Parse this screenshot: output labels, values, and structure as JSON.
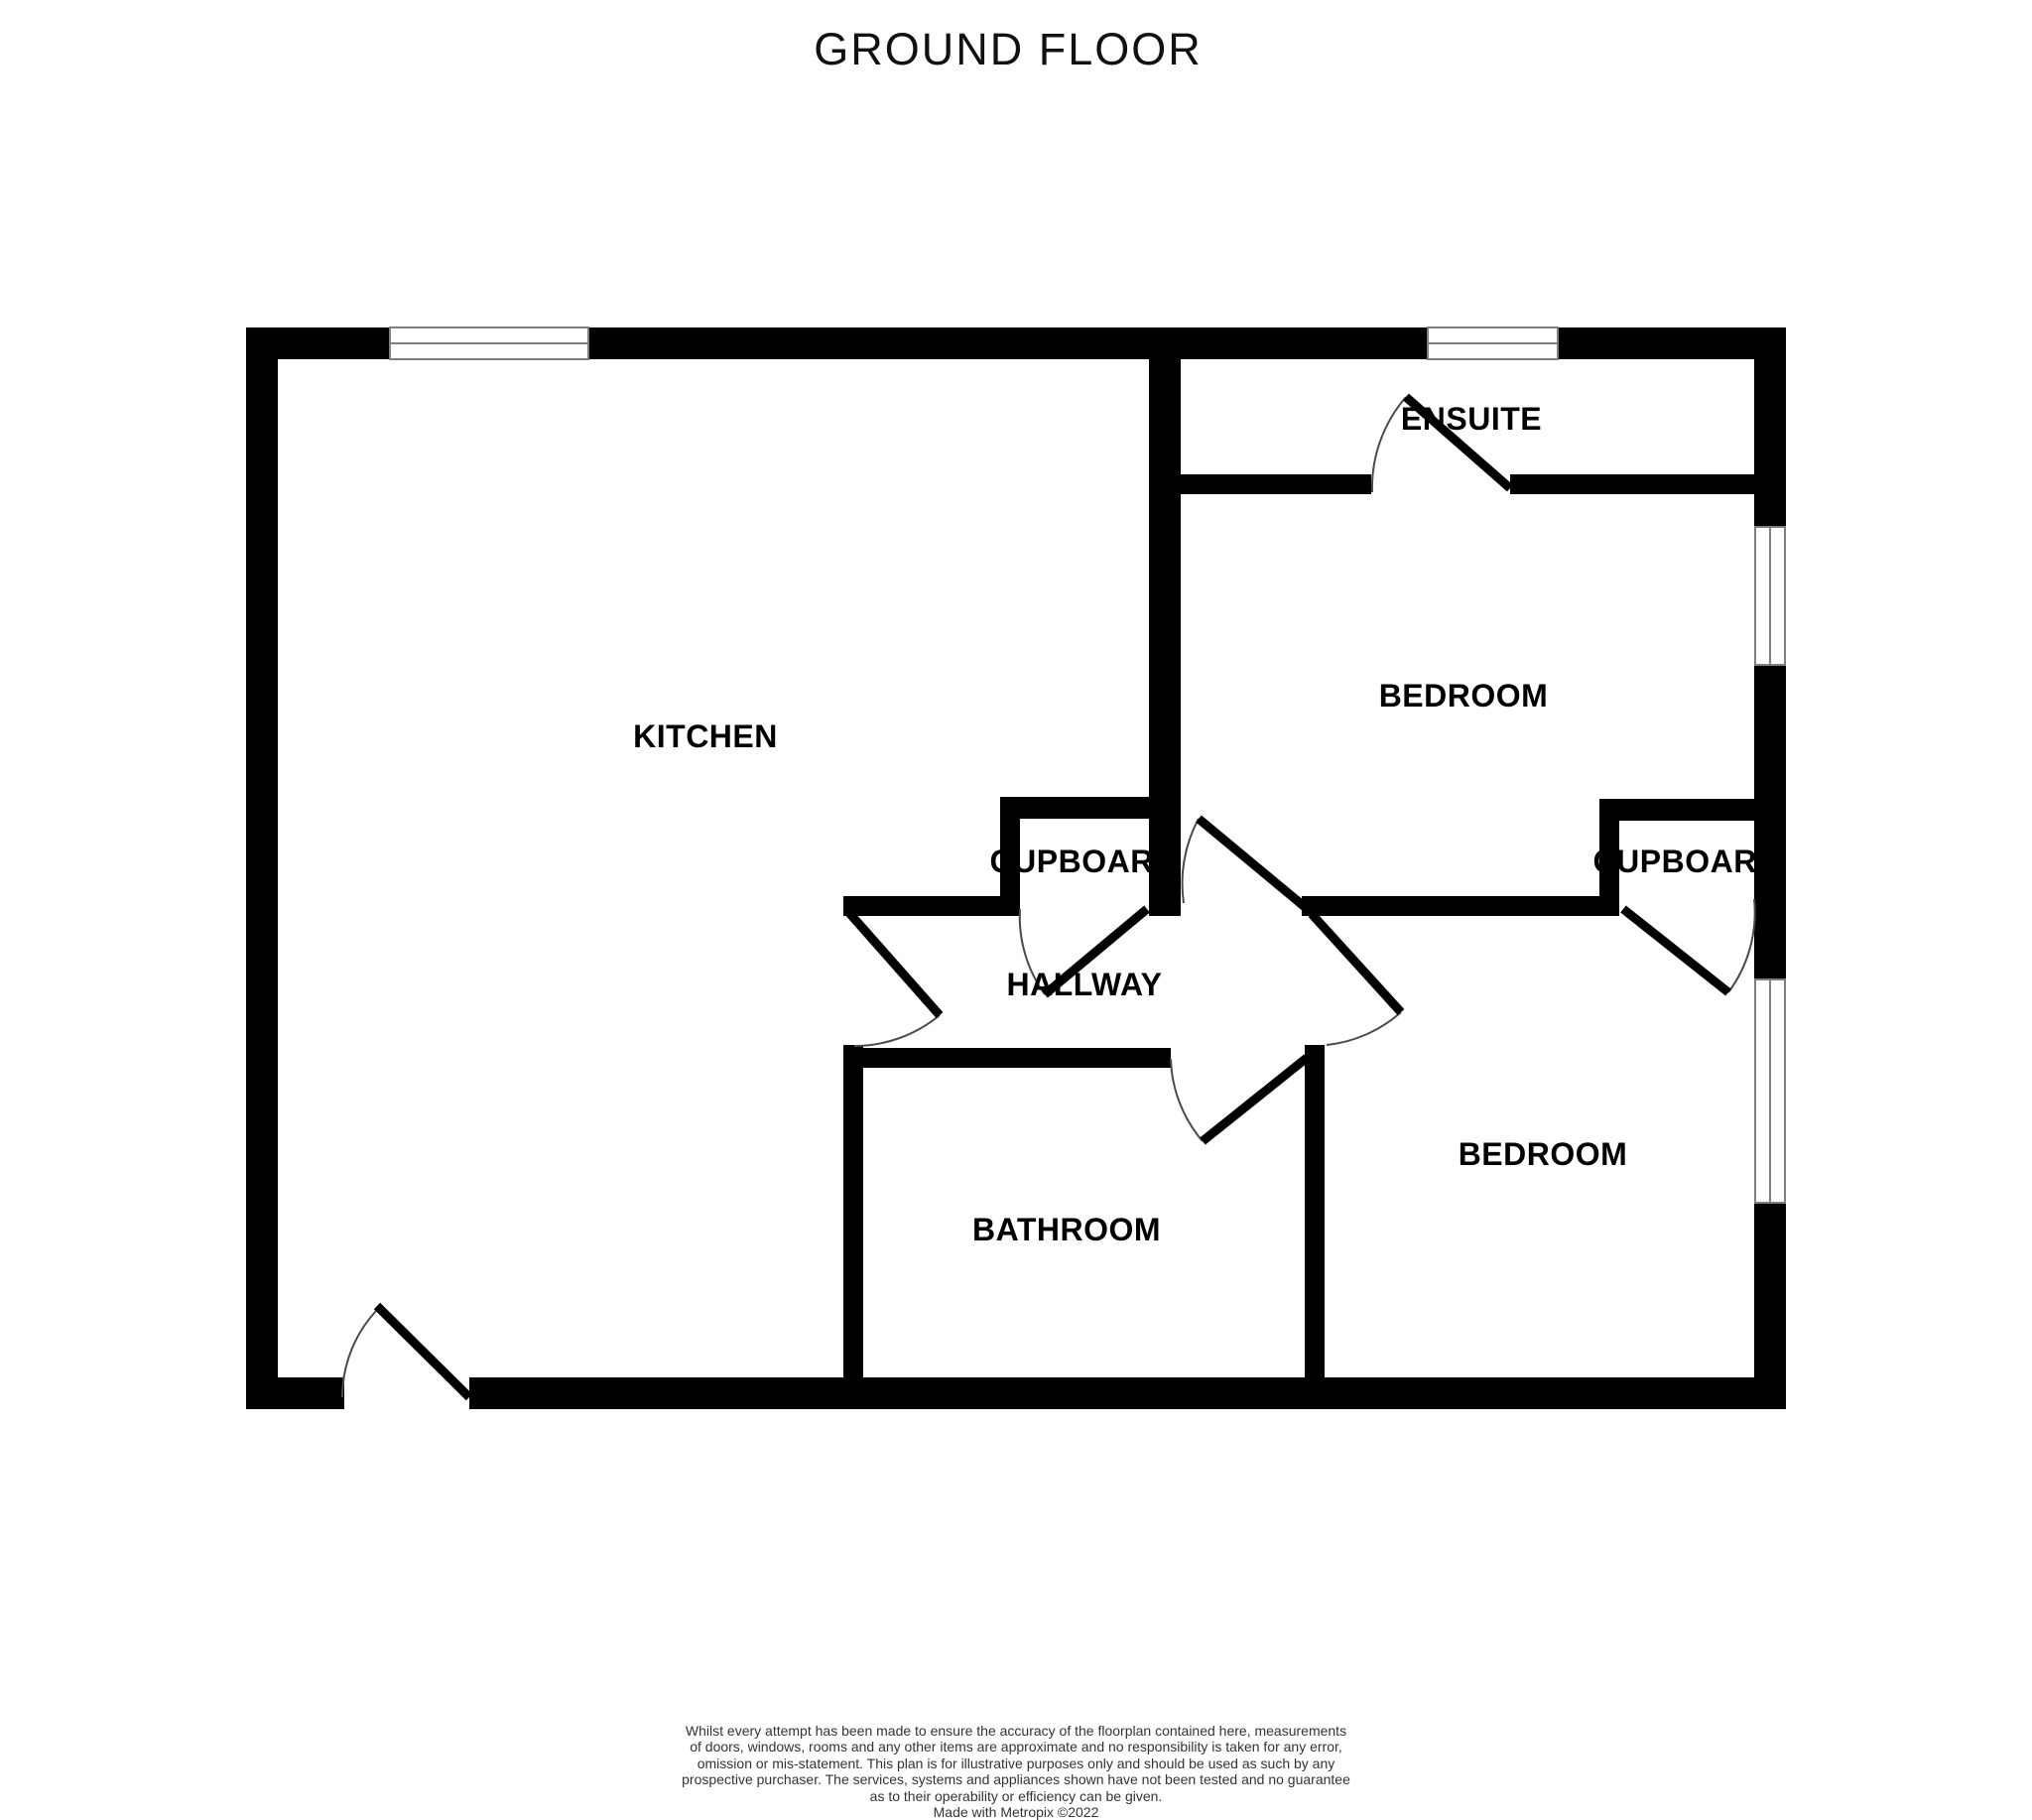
{
  "title": "GROUND FLOOR",
  "rooms": {
    "kitchen": {
      "label": "KITCHEN"
    },
    "ensuite": {
      "label": "ENSUITE"
    },
    "bedroom_top": {
      "label": "BEDROOM"
    },
    "bedroom_bottom": {
      "label": "BEDROOM"
    },
    "cupboard_left": {
      "label": "CUPBOARD"
    },
    "cupboard_right": {
      "label": "CUPBOARD"
    },
    "hallway": {
      "label": "HALLWAY"
    },
    "bathroom": {
      "label": "BATHROOM"
    }
  },
  "colors": {
    "wall": "#000000",
    "window_frame": "#7f7f7f",
    "door_arc": "#4a4a4a",
    "door_leaf": "#000000"
  },
  "disclaimer": {
    "lines": [
      "Whilst every attempt has been made to ensure the accuracy of the floorplan contained here, measurements",
      "of doors, windows, rooms and any other items are approximate and no responsibility is taken for any error,",
      "omission or mis-statement. This plan is for illustrative purposes only and should be used as such by any",
      "prospective purchaser. The services, systems and appliances shown have not been tested and no guarantee",
      "as to their operability or efficiency can be given."
    ],
    "credit": "Made with Metropix ©2022"
  }
}
